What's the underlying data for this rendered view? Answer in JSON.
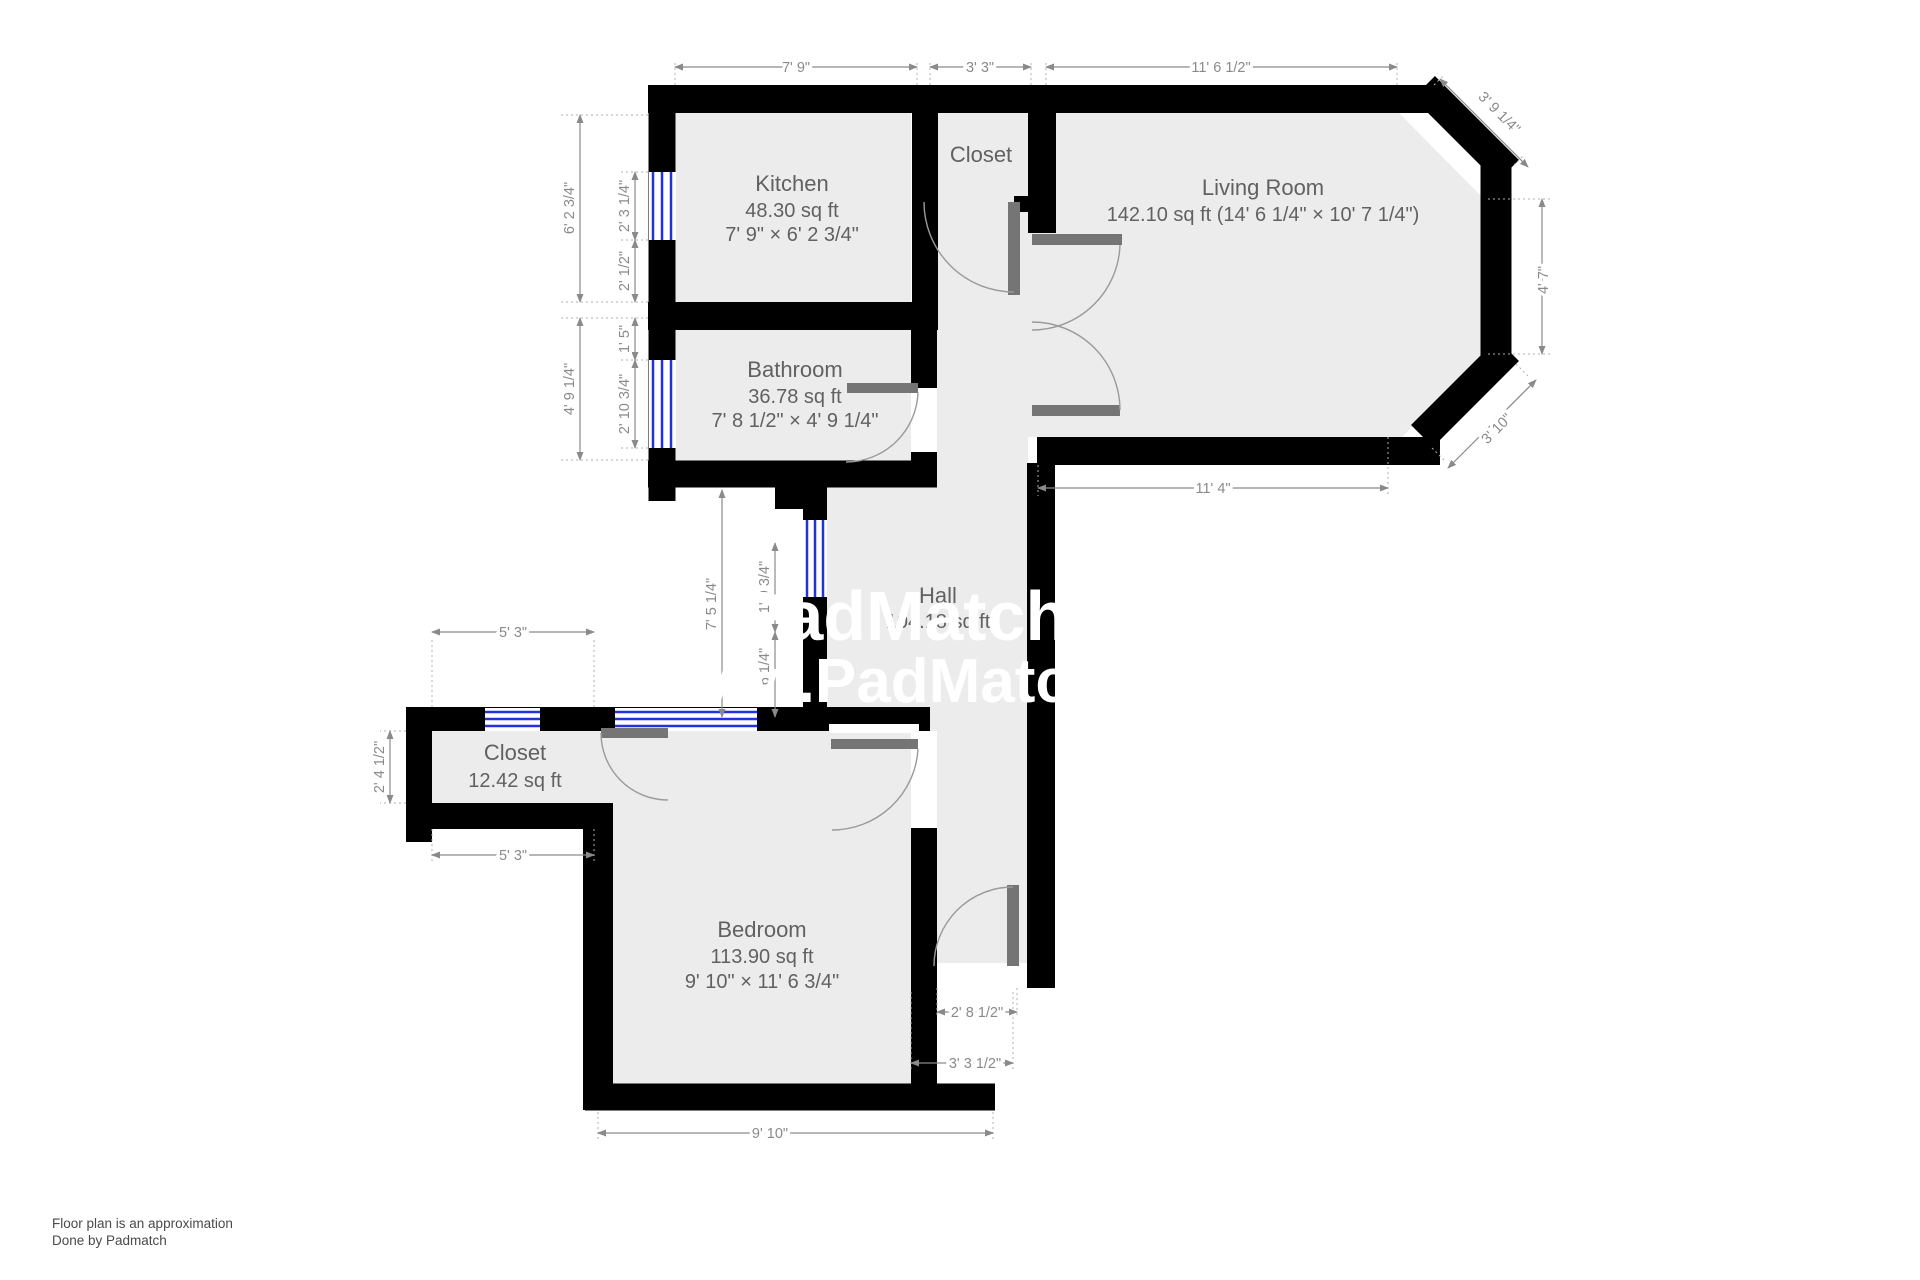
{
  "rooms": {
    "kitchen": {
      "name": "Kitchen",
      "area": "48.30 sq ft",
      "size": "7' 9\" × 6' 2 3/4\""
    },
    "closet_top": {
      "name": "Closet"
    },
    "living": {
      "name": "Living Room",
      "area_size": "142.10 sq ft (14' 6 1/4\" × 10' 7 1/4\")"
    },
    "bathroom": {
      "name": "Bathroom",
      "area": "36.78 sq ft",
      "size": "7' 8 1/2\" × 4' 9 1/4\""
    },
    "hall": {
      "name": "Hall",
      "area": "104.18 sq ft"
    },
    "closet_low": {
      "name": "Closet",
      "area": "12.42 sq ft"
    },
    "bedroom": {
      "name": "Bedroom",
      "area": "113.90 sq ft",
      "size": "9' 10\" × 11' 6 3/4\""
    }
  },
  "dims": {
    "top_kitchen": "7' 9\"",
    "top_closet": "3' 3\"",
    "top_living": "11' 6 1/2\"",
    "chamfer_top": "3' 9 1/4\"",
    "right_side": "4' 7\"",
    "chamfer_bottom": "3' 10\"",
    "living_bottom": "11' 4\"",
    "kitchen_height": "6' 2 3/4\"",
    "kitchen_window": "2' 3 1/4\"",
    "kitchen_lower": "2' 1/2\"",
    "bath_upper": "1' 5\"",
    "bath_height": "4' 9 1/4\"",
    "bath_window": "2' 10 3/4\"",
    "hall_height": "7' 5 1/4\"",
    "hall_window": "1' 9 3/4\"",
    "hall_lower": "2' 6 1/4\"",
    "closet_top_w": "5' 3\"",
    "closet_height": "2' 4 1/2\"",
    "closet_bottom_w": "5' 3\"",
    "entry_width": "2' 8 1/2\"",
    "vestibule_width": "3' 3 1/2\"",
    "bedroom_width": "9' 10\""
  },
  "watermark": {
    "line1": "PadMatch R",
    "line2": "ww.PadMatchR"
  },
  "footer": {
    "line1": "Floor plan is an approximation",
    "line2": "Done by Padmatch"
  },
  "colors": {
    "wall": "#000000",
    "room_fill": "#ececec",
    "door": "#757575",
    "dimension": "#8a8a8a",
    "window_blue": "#2233dd",
    "watermark": "#ffffff"
  }
}
